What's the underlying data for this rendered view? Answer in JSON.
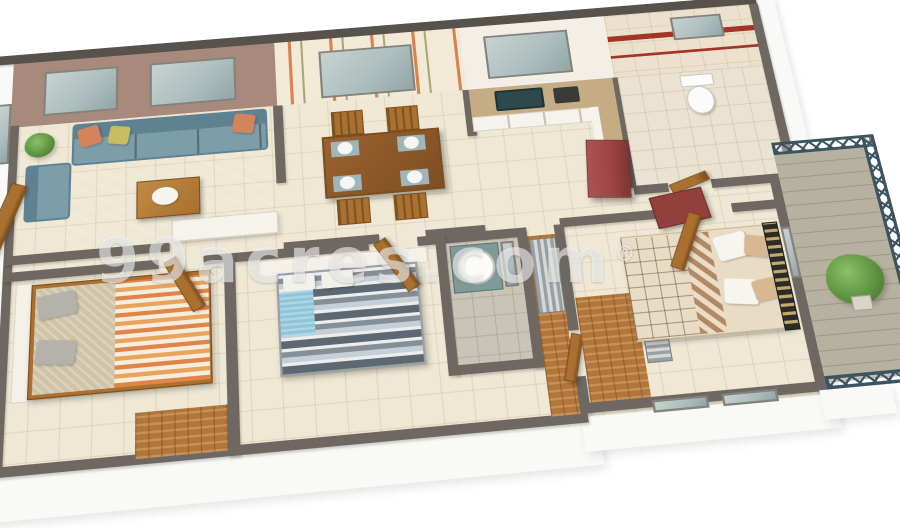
{
  "watermark": {
    "text": "99acres.com",
    "reg": "®"
  },
  "palette": {
    "wall_top": "#6f6862",
    "wall_cap": "#57524c",
    "outer_white": "#f9f9f7",
    "floor": "#efe8d5",
    "living_wall": "#a78a7b",
    "rug": "#7b6b54",
    "sofa": "#7e9dab",
    "sofa_dark": "#5f8292",
    "pillow_orange": "#d4845c",
    "pillow_yellow": "#c8bd62",
    "pillow_gray": "#b5b2ab",
    "wood": "#a9702f",
    "wood_dark": "#7c4e1d",
    "wood_floor": "#b3763a",
    "counter": "#c6ac85",
    "cabinet_white": "#f6f3ec",
    "sink": "#2e484c",
    "fridge": "#9c4343",
    "tile_bath": "#ece1cd",
    "stripe_red": "#a23528",
    "toilet_white": "#fbfbf9",
    "bed1_orange": "#e0854a",
    "bed1_cream": "#f6eedd",
    "bed1_linen": "#cfc3a8",
    "headboard_white": "#f4f1e9",
    "bed2_dark": "#5d6873",
    "bed2_light": "#c6cfd5",
    "bed2_teal": "#8fc5da",
    "bed3_brown": "#6f4a36",
    "bed3_tan": "#8a6248",
    "bed3_check": "#b08a64",
    "hb_black": "#2b2b28",
    "hb_gold": "#c5a96b",
    "accent_red": "#93403c",
    "balcony_floor": "#b7b1a0",
    "railing": "#3c5460",
    "plant": "#5f9441",
    "glass": "#aebfbf",
    "watermark_color": "rgba(255,255,255,0.55)"
  },
  "rooms": [
    {
      "name": "living-room",
      "items": [
        "sofa",
        "armchair",
        "coffee-table",
        "rug",
        "plant",
        "entrance-door",
        "windows"
      ]
    },
    {
      "name": "dining-room",
      "items": [
        "striped-wallpaper",
        "window",
        "dining-table",
        "four-chairs",
        "plates"
      ]
    },
    {
      "name": "kitchen",
      "items": [
        "window",
        "sink",
        "l-counter",
        "stove",
        "refrigerator"
      ]
    },
    {
      "name": "bathroom-1",
      "items": [
        "red-stripe-tiles",
        "toilet",
        "window"
      ]
    },
    {
      "name": "bedroom-1",
      "items": [
        "chevron-bed",
        "gray-pillows",
        "door",
        "wood-ledge"
      ]
    },
    {
      "name": "bedroom-2",
      "items": [
        "striped-bed",
        "teal-throw",
        "white-headboard",
        "door"
      ]
    },
    {
      "name": "bathroom-2",
      "items": [
        "washbasin",
        "mirror",
        "slatted-panel"
      ]
    },
    {
      "name": "master-bedroom",
      "items": [
        "patchwork-bed",
        "gold-black-headboard",
        "red-chair",
        "wood-bench",
        "balcony-window"
      ]
    },
    {
      "name": "balcony",
      "items": [
        "lattice-railing",
        "potted-plant",
        "tile-floor"
      ]
    }
  ]
}
